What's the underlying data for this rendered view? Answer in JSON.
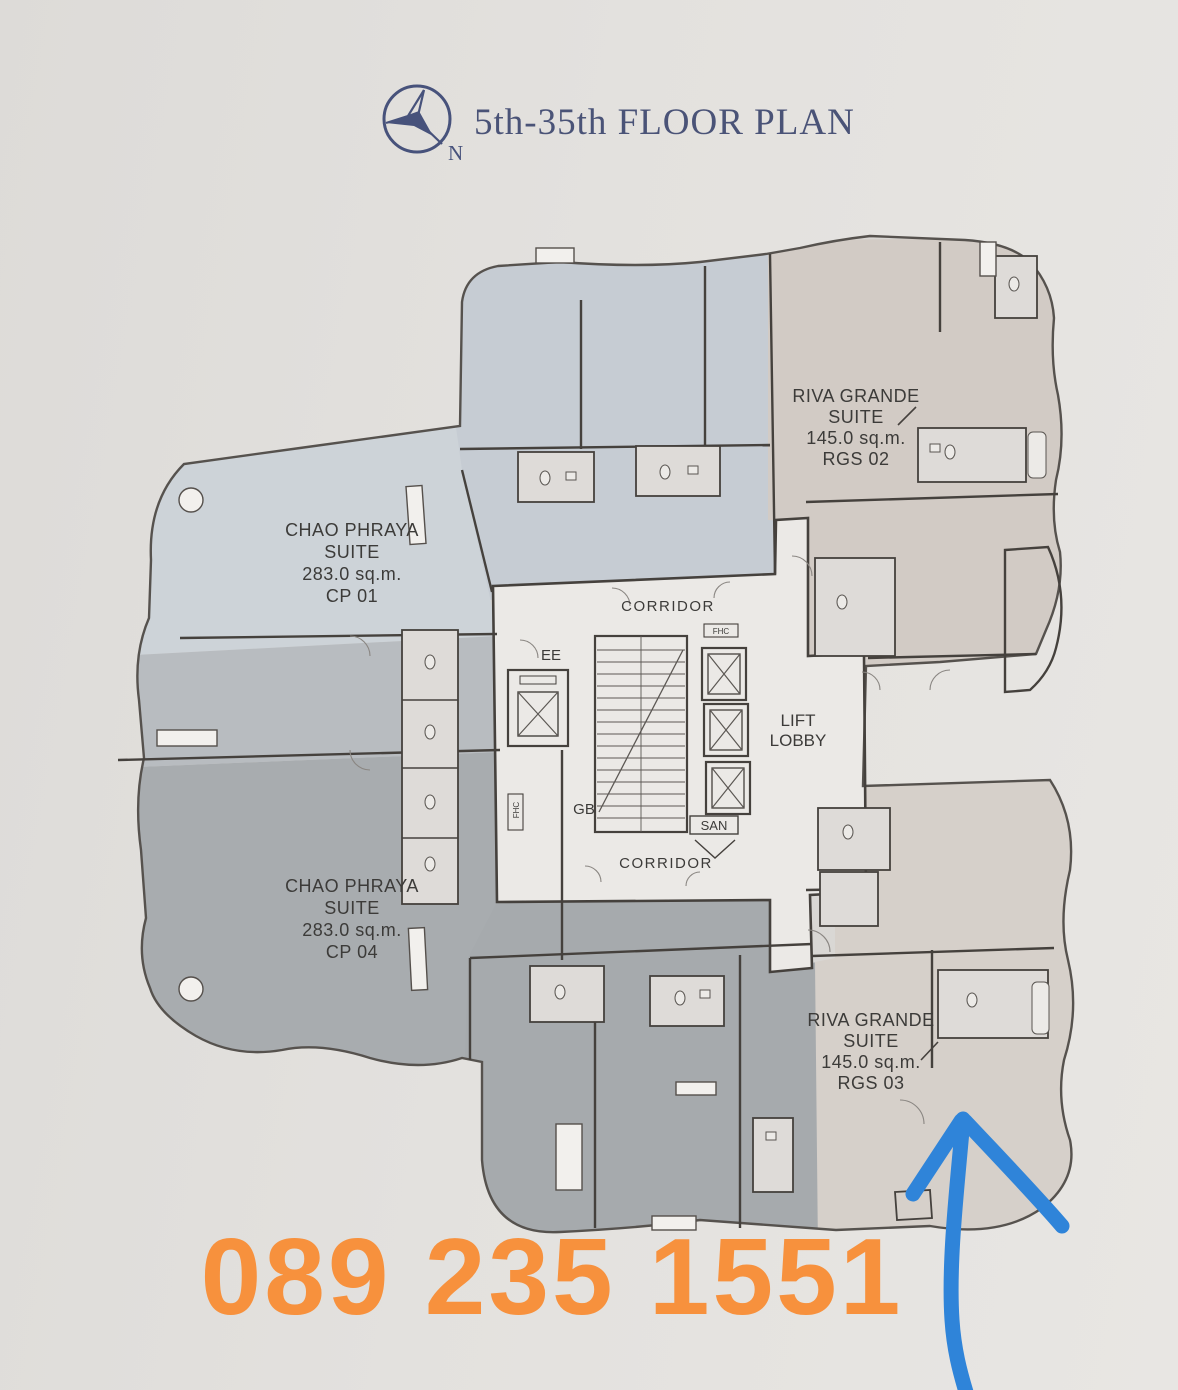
{
  "header": {
    "title": "5th-35th FLOOR PLAN",
    "compass_n": "N"
  },
  "units": {
    "cp01": {
      "name1": "CHAO PHRAYA",
      "name2": "SUITE",
      "area": "283.0 sq.m.",
      "code": "CP 01"
    },
    "cp04": {
      "name1": "CHAO PHRAYA",
      "name2": "SUITE",
      "area": "283.0 sq.m.",
      "code": "CP 04"
    },
    "rgs02": {
      "name1": "RIVA GRANDE",
      "name2": "SUITE",
      "area": "145.0 sq.m.",
      "code": "RGS 02"
    },
    "rgs03": {
      "name1": "RIVA GRANDE",
      "name2": "SUITE",
      "area": "145.0 sq.m.",
      "code": "RGS 03"
    }
  },
  "core": {
    "corridor_top": "CORRIDOR",
    "corridor_bottom": "CORRIDOR",
    "lift_line1": "LIFT",
    "lift_line2": "LOBBY",
    "ee": "EE",
    "gb": "GB",
    "san": "SAN",
    "fhc_top": "FHC",
    "fhc_side": "FHC"
  },
  "annotations": {
    "phone": "089 235 1551"
  },
  "colors": {
    "phone_orange": "#f7913d",
    "arrow_blue": "#2f84d9",
    "title_navy": "#4a5377",
    "cp_suite_light": "#cdd3d8",
    "cp_suite_mid": "#b8bcc0",
    "cp_suite_dark": "#a8acaf",
    "top_rooms_bluegray": "#c6ccd3",
    "bottom_rooms_gray": "#a6aaad",
    "rgs_suite_beige": "#d2cbc5",
    "core_light": "#ebe9e6",
    "walls": "#45413d"
  }
}
